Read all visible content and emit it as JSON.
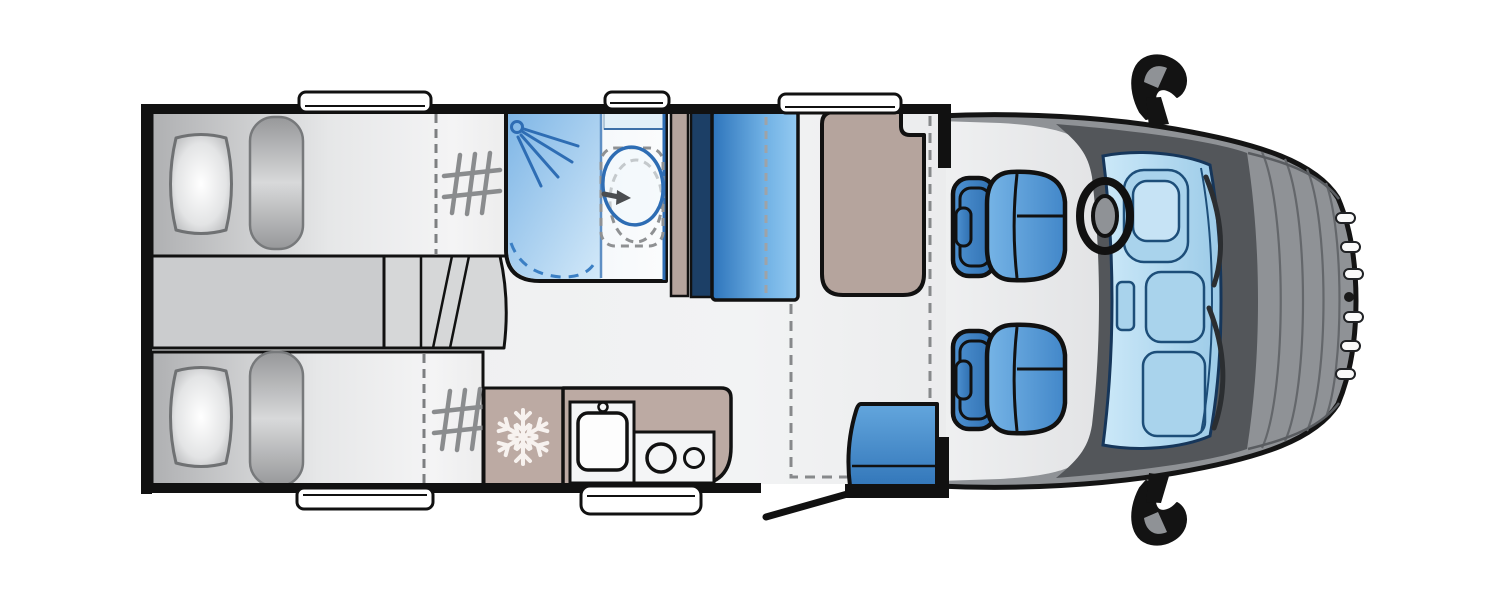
{
  "floorplan": {
    "title": "Motorhome floor plan – top-down view, cab at right",
    "vehicle_type": "coachbuilt motorhome",
    "view": "top-down plan",
    "front_of_vehicle": "right",
    "rooms": [
      {
        "name": "rear-bedroom",
        "furniture": [
          "single-bed-top",
          "single-bed-bottom",
          "pillow-top",
          "pillow-bottom",
          "bolster-top",
          "bolster-bottom",
          "steps-between-beds",
          "grab-rail-top",
          "grab-rail-bottom"
        ]
      },
      {
        "name": "bathroom",
        "furniture": [
          "shower-tray",
          "shower-head",
          "swivel-toilet",
          "toilet-alternate-position-dashed",
          "shower-door-swing-arc",
          "cassette-shelf"
        ]
      },
      {
        "name": "wardrobe",
        "furniture": [
          "wardrobe-cabinet",
          "partition-wall"
        ]
      },
      {
        "name": "lounge",
        "furniture": [
          "side-bench",
          "travel-seat",
          "drop-down-bed-dashed-outline",
          "entry-door"
        ]
      },
      {
        "name": "kitchen",
        "furniture": [
          "fridge",
          "sink",
          "two-burner-hob",
          "worktop"
        ]
      },
      {
        "name": "cab",
        "furniture": [
          "driver-swivel-seat",
          "passenger-swivel-seat",
          "steering-wheel",
          "dashboard",
          "windscreen",
          "wing-mirror-top",
          "wing-mirror-bottom",
          "bonnet",
          "front-grille"
        ]
      }
    ],
    "windows_count": 5,
    "icons": [
      "snowflake-icon",
      "shower-head-icon",
      "toilet-icon",
      "swivel-arrow-icon",
      "grab-rail-icon",
      "steering-wheel-icon"
    ]
  },
  "palette": {
    "wall": "#111111",
    "floor": "#ECEDEE",
    "floor_dark": "#CBCCCE",
    "step": "#D6D7D8",
    "bed_dark": "#AFB0B2",
    "bed_mid": "#E6E7E8",
    "bed_light": "#F4F4F5",
    "tan": "#B5A49D",
    "tan_kitchen": "#BCAAA3",
    "navy": "#1C3F66",
    "wardrobe_dark": "#2D74BB",
    "wardrobe_mid": "#6FB0E4",
    "wardrobe_light": "#94CAF1",
    "shower_dark": "#7FB6E6",
    "shower_light": "#D3E9F9",
    "fixture_blue": "#2E6DB4",
    "seat_light": "#63A6DD",
    "seat_dark": "#3377BA",
    "cab_seat_back_light": "#4E92D2",
    "cab_seat_back_dark": "#2F6FB0",
    "cab_seat_cushion_light": "#76B4E6",
    "cab_seat_cushion_dark": "#4287C9",
    "cab_body": "#8F9296",
    "cab_dark": "#53565A",
    "windscreen_light": "#CBE8F8",
    "windscreen_dark": "#9CCBE8",
    "dash_fill": "#A9D3EC",
    "dash_stroke": "#1D4E79",
    "snowflake": "#F7F2EF",
    "window_fill": "#FFFFFF"
  }
}
